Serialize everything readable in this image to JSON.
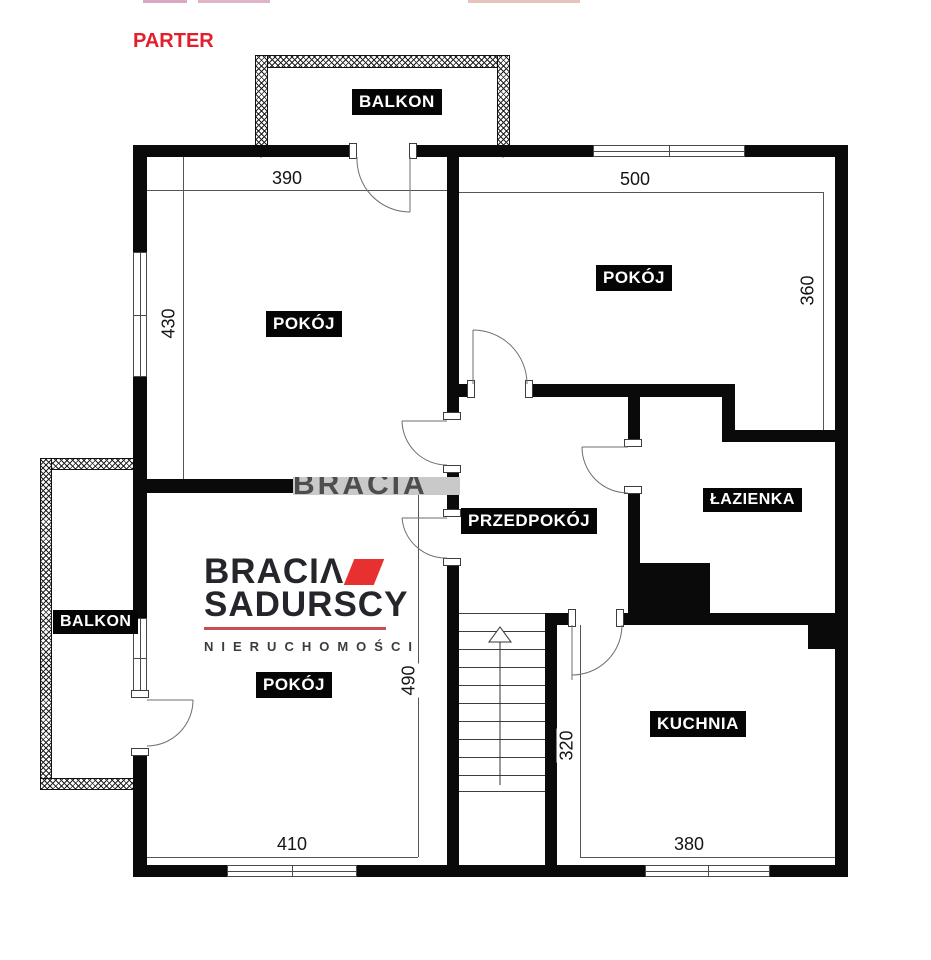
{
  "title": {
    "text": "PARTER",
    "color": "#e31e2d"
  },
  "rooms": [
    {
      "id": "room-top-left",
      "label": "POKÓJ"
    },
    {
      "id": "room-top-right",
      "label": "POKÓJ"
    },
    {
      "id": "hallway",
      "label": "PRZEDPOKÓJ"
    },
    {
      "id": "bathroom",
      "label": "ŁAZIENKA"
    },
    {
      "id": "room-bottom-left",
      "label": "POKÓJ"
    },
    {
      "id": "kitchen",
      "label": "KUCHNIA"
    }
  ],
  "balconies": [
    {
      "id": "balcony-top",
      "label": "BALKON"
    },
    {
      "id": "balcony-left",
      "label": "BALKON"
    }
  ],
  "dimensions": {
    "room_top_left_width": "390",
    "room_top_left_height": "430",
    "room_top_right_width": "500",
    "room_top_right_height": "360",
    "room_bottom_left_width": "410",
    "room_bottom_left_height": "490",
    "kitchen_width": "380",
    "kitchen_height": "320"
  },
  "watermark": {
    "text": "BRACIA"
  },
  "logo": {
    "line1": "BRACIΛ",
    "line2": "SADURSCY",
    "line3": "NIERUCHOMOŚCI",
    "accent_color": "#e63130",
    "divider_color": "#c74f4f"
  },
  "colors": {
    "wall": "#0a0a0a",
    "title_red": "#e31e2d"
  }
}
